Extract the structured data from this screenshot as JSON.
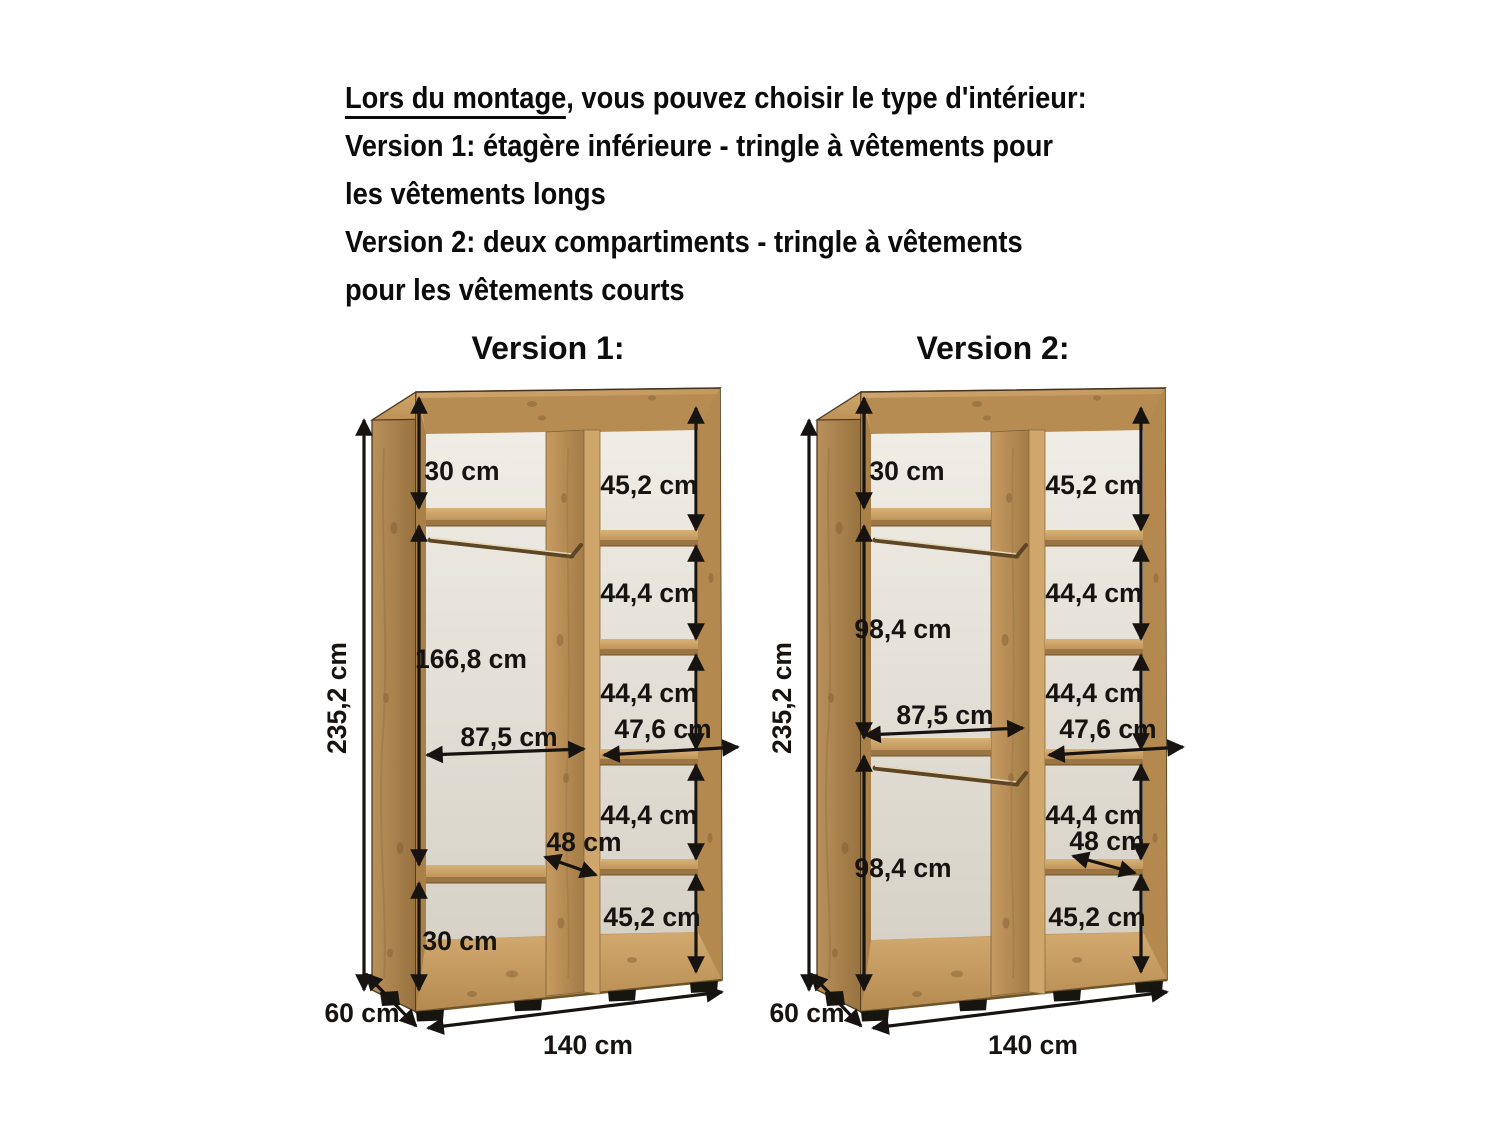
{
  "background": "#ffffff",
  "header": {
    "intro_underlined": "Lors du montage",
    "intro_rest": ", vous pouvez choisir le type d'intérieur:",
    "version1_line1": "Version 1: étagère inférieure - tringle à vêtements pour",
    "version1_line2": "les vêtements longs",
    "version2_line1": "Version 2: deux compartiments - tringle à vêtements",
    "version2_line2": "pour les vêtements courts"
  },
  "diagrams": [
    {
      "title": "Version 1:",
      "dims": {
        "height": "235,2 cm",
        "depth": "60 cm",
        "width": "140 cm",
        "top_section": "30 cm",
        "main_section": "166,8 cm",
        "bottom_section": "30 cm",
        "interior_width": "87,5 cm",
        "shelf_depth": "48 cm",
        "right_shelf_depth": "47,6 cm",
        "right_sections": [
          "45,2 cm",
          "44,4 cm",
          "44,4 cm",
          "44,4 cm",
          "45,2 cm"
        ]
      }
    },
    {
      "title": "Version 2:",
      "dims": {
        "height": "235,2 cm",
        "depth": "60 cm",
        "width": "140 cm",
        "top_section": "30 cm",
        "upper_section": "98,4 cm",
        "lower_section": "98,4 cm",
        "interior_width": "87,5 cm",
        "shelf_depth": "48 cm",
        "right_shelf_depth": "47,6 cm",
        "right_sections": [
          "45,2 cm",
          "44,4 cm",
          "44,4 cm",
          "44,4 cm",
          "45,2 cm"
        ]
      }
    }
  ],
  "colors": {
    "wood": "#c89f66",
    "wood_dark": "#9a7443",
    "panel_back": "#eae6de",
    "dimension": "#161310",
    "text": "#0b0b0b"
  }
}
